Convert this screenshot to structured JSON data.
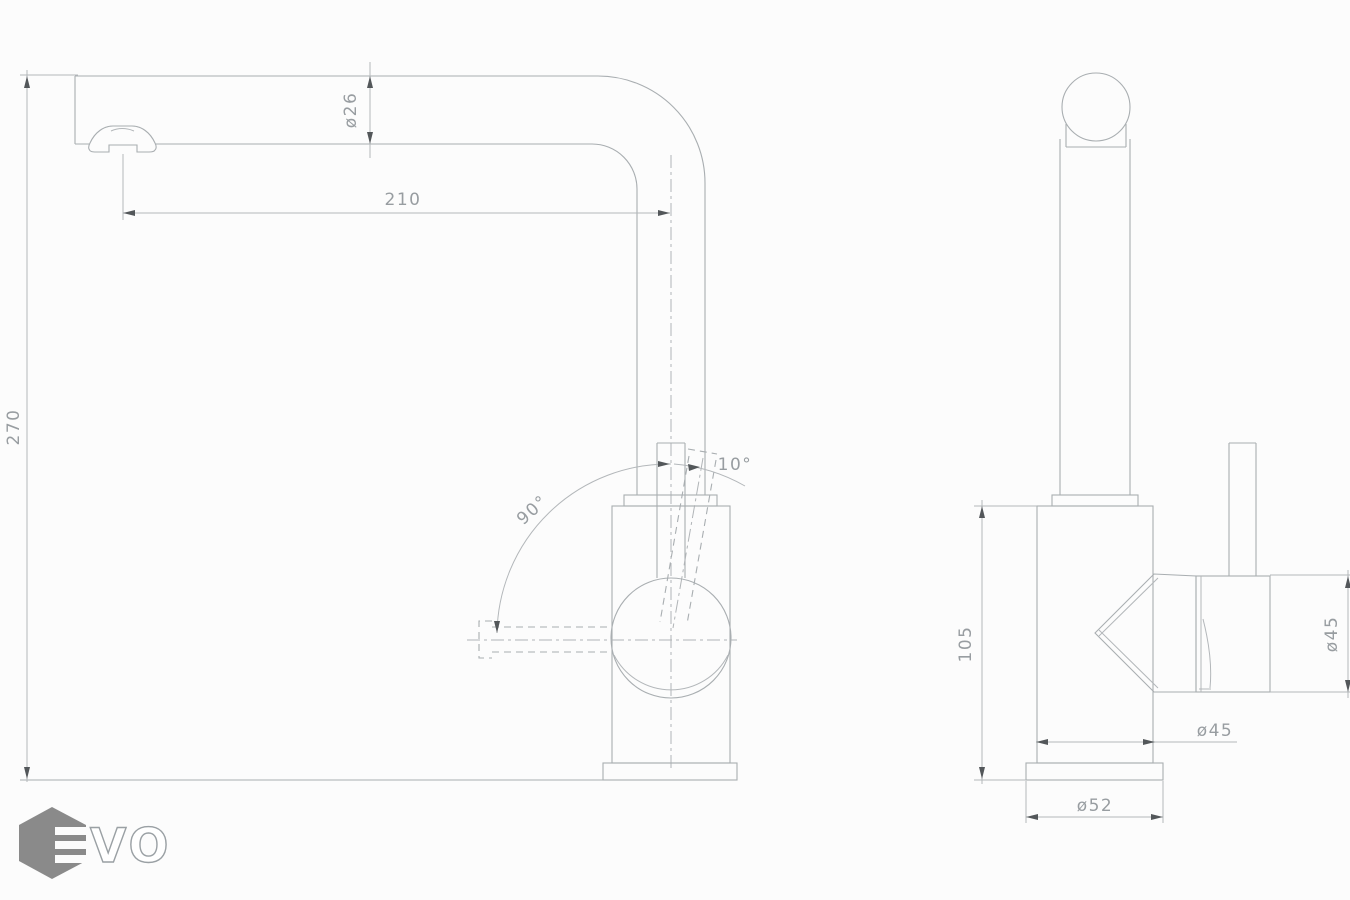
{
  "drawing": {
    "type": "faucet technical drawing, two orthographic views",
    "background_color": "#fcfcfc",
    "line_color": "#a9aeb1",
    "arrow_color": "#53575a",
    "text_color": "#989da1"
  },
  "side_view": {
    "name": "side view",
    "dims": {
      "overall_height": "270",
      "spout_reach": "210",
      "spout_diameter": "ø26",
      "swivel_angle": "90°",
      "handle_tilt_angle": "10°"
    }
  },
  "front_view": {
    "name": "front view",
    "dims": {
      "body_height": "105",
      "body_diameter": "ø45",
      "handle_diameter": "ø45",
      "base_diameter": "ø52"
    }
  },
  "logo": {
    "brand": "EVO",
    "outlined_letters": "VO",
    "hexagon_color": "#8a8a8a",
    "letter_outline_color": "#9aa0a4"
  }
}
